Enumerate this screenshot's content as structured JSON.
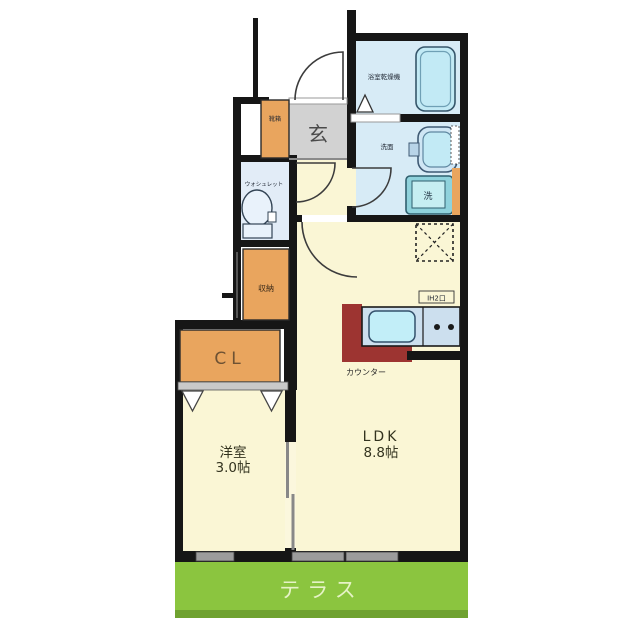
{
  "plan": {
    "type": "floor-plan",
    "labels": {
      "genkan": "玄",
      "shoebox": "靴箱",
      "toilet_unit": "ウォシュレット",
      "storage": "収納",
      "bath_dryer": "浴室乾燥機",
      "washstand": "洗面",
      "washer_pan": "洗",
      "closet": "CL",
      "western_room_name": "洋室",
      "western_room_size": "3.0帖",
      "ldk_name": "LDK",
      "ldk_size": "8.8帖",
      "kitchen_counter": "カウンター",
      "stove_tag": "IH2口",
      "terrace": "テラス"
    },
    "colors": {
      "wall": "#161616",
      "room_cream": "#faf6d5",
      "wet_area_blue": "#d7ebf6",
      "toilet_room_blue": "#e2ecf7",
      "storage_orange": "#e9a55e",
      "entrance_gray": "#d2d2d2",
      "kitchen_counter_red": "#9d3431",
      "terrace_green": "#8bc53f",
      "terrace_green_dark": "#6fa230",
      "fixture_blue": "#c2eaf5"
    }
  }
}
